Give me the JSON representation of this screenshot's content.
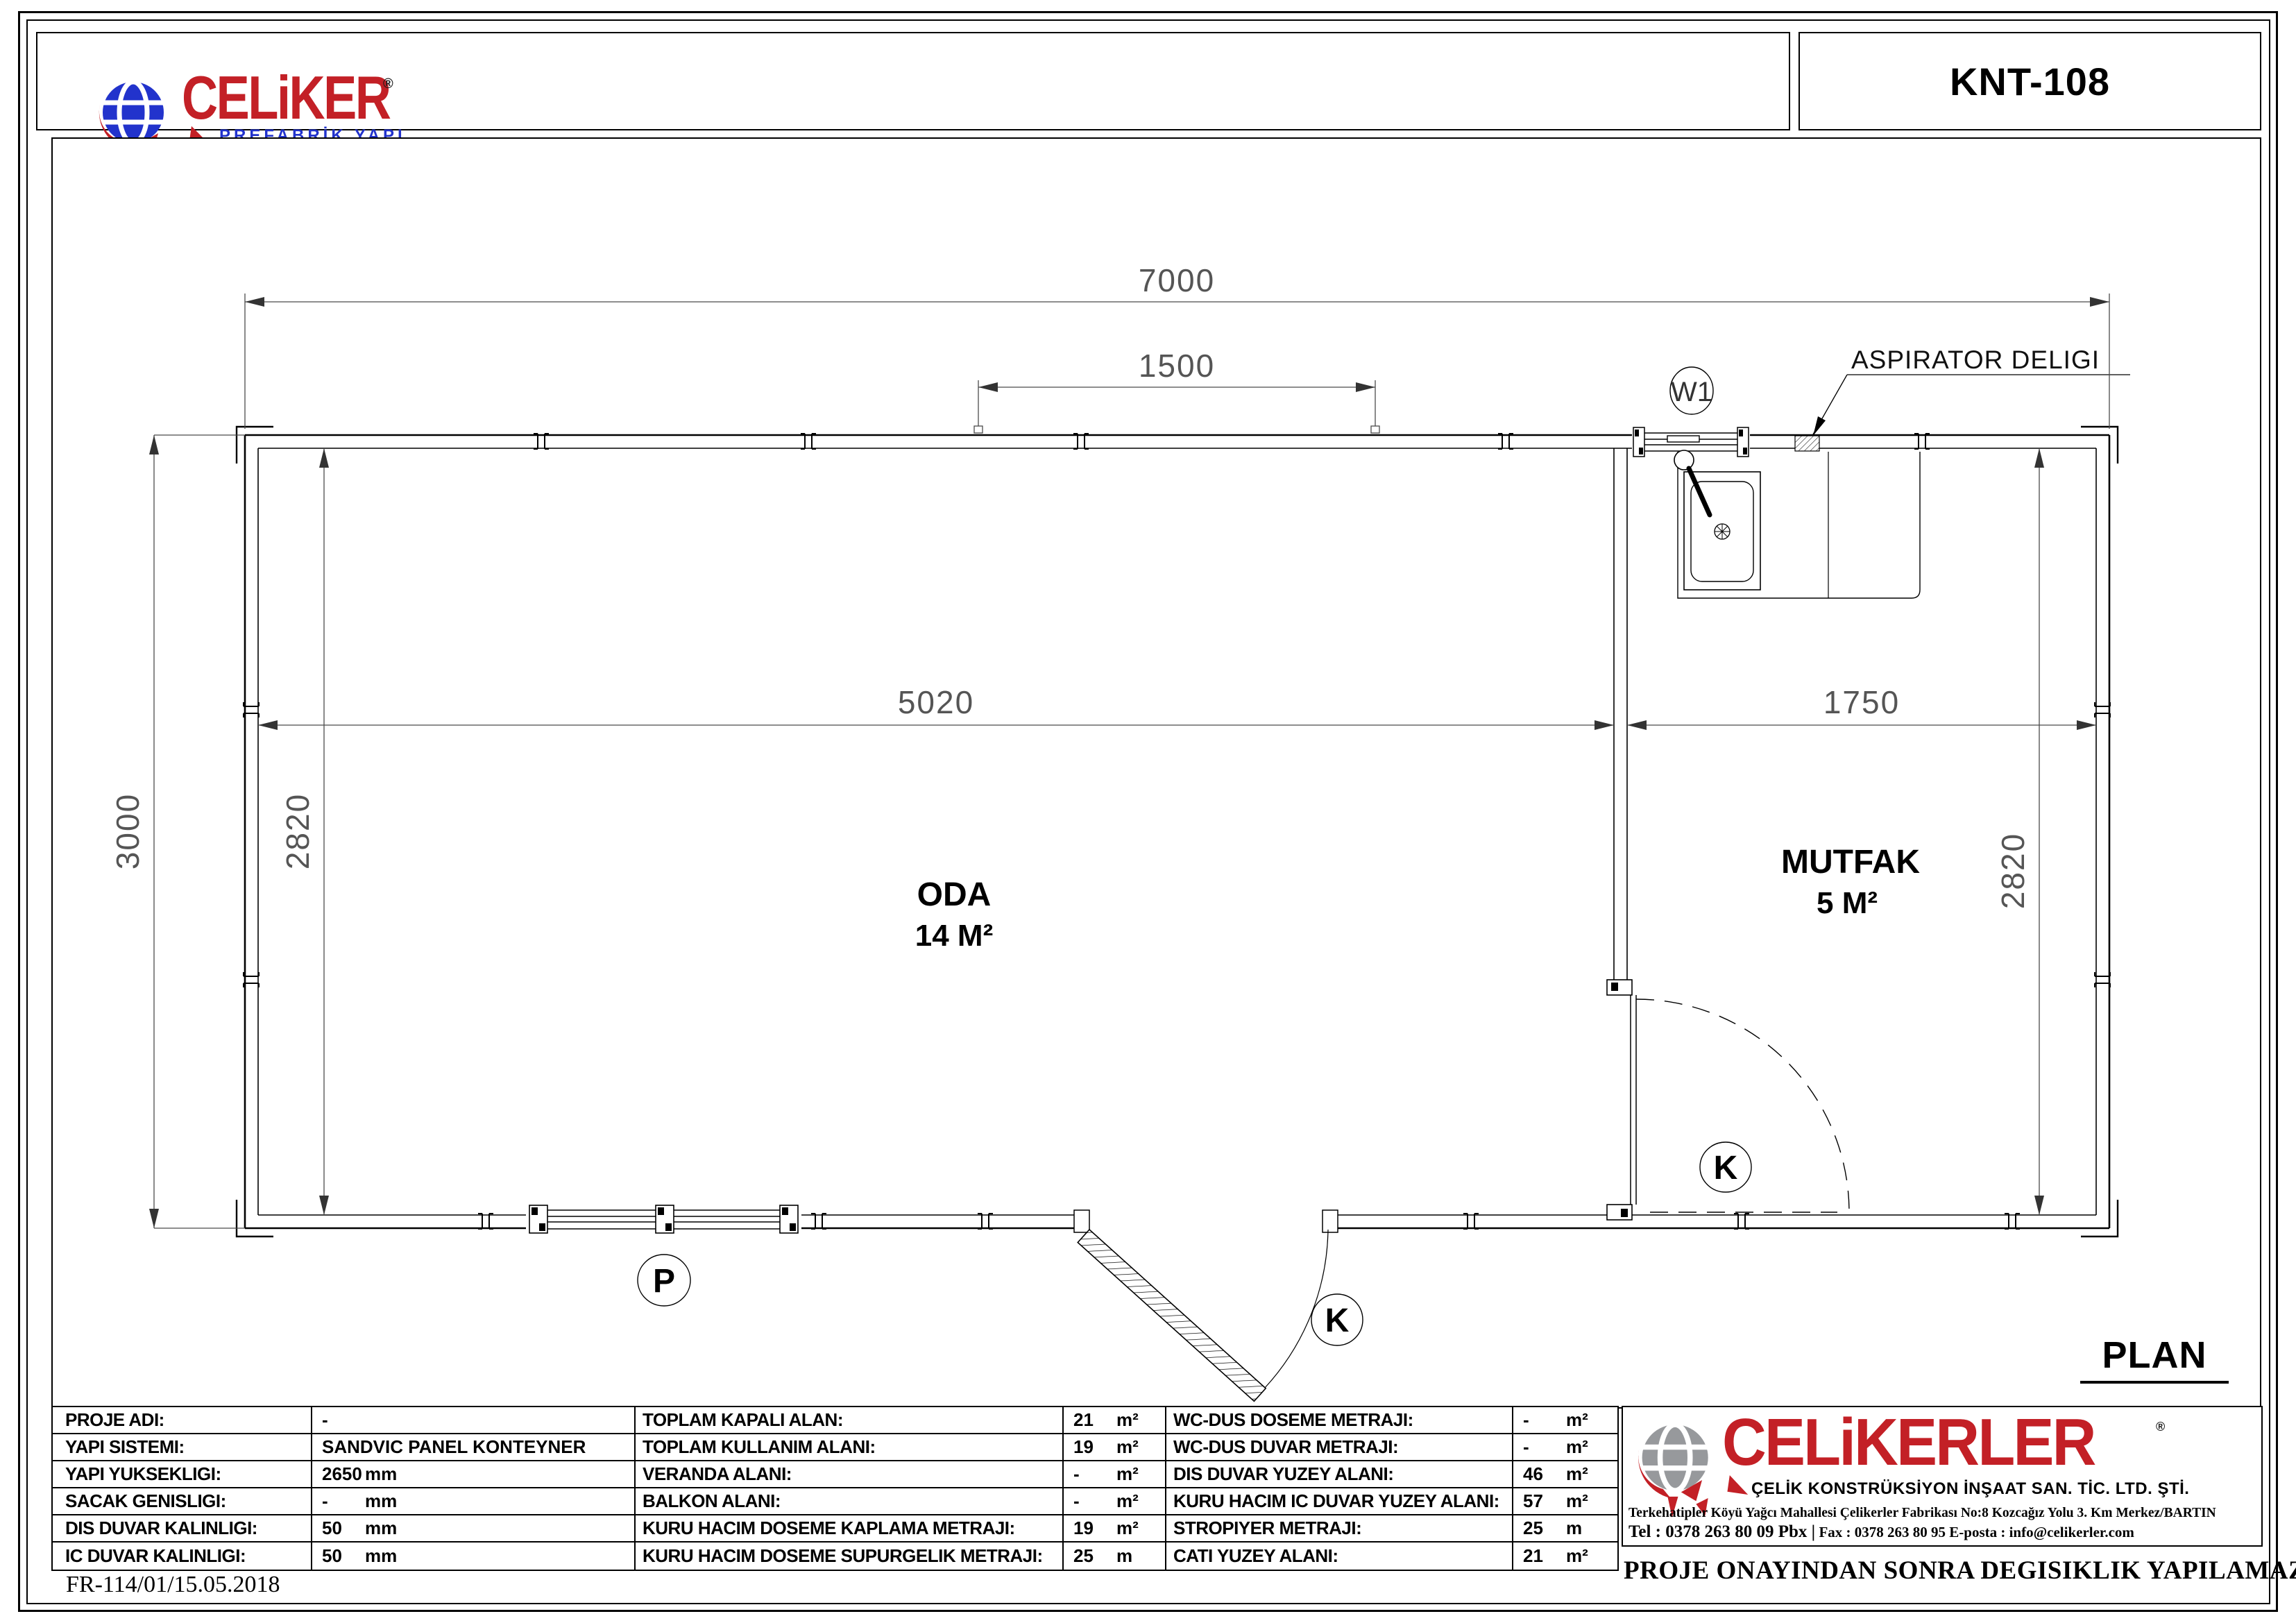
{
  "header": {
    "brand": {
      "name": "CELiKER",
      "registered": "®",
      "tagline": "PREFABRİK YAPI"
    },
    "model": "KNT-108"
  },
  "plan": {
    "title": "PLAN",
    "annotation": "ASPIRATOR DELIGI",
    "dims": {
      "total_width": "7000",
      "top_opening": "1500",
      "oda_width": "5020",
      "mutfak_width": "1750",
      "total_depth": "3000",
      "oda_depth": "2820",
      "mutfak_depth": "2820"
    },
    "rooms": {
      "oda": {
        "name": "ODA",
        "area": "14 M²"
      },
      "mutfak": {
        "name": "MUTFAK",
        "area": "5 M²"
      }
    },
    "marks": {
      "w1": "W1",
      "p": "P",
      "k_ext": "K",
      "k_int": "K"
    }
  },
  "tables": {
    "left": {
      "rows": [
        {
          "label": "PROJE ADI:",
          "value": "-",
          "unit": ""
        },
        {
          "label": "YAPI SISTEMI:",
          "value": "SANDVIC PANEL KONTEYNER",
          "unit": ""
        },
        {
          "label": "YAPI YUKSEKLIGI:",
          "value": "2650",
          "unit": "mm"
        },
        {
          "label": "SACAK GENISLIGI:",
          "value": "-",
          "unit": "mm"
        },
        {
          "label": "DIS DUVAR KALINLIGI:",
          "value": "50",
          "unit": "mm"
        },
        {
          "label": "IC DUVAR KALINLIGI:",
          "value": "50",
          "unit": "mm"
        }
      ]
    },
    "middle": {
      "rows": [
        {
          "label": "TOPLAM KAPALI ALAN:",
          "value": "21",
          "unit": "m²"
        },
        {
          "label": "TOPLAM KULLANIM ALANI:",
          "value": "19",
          "unit": "m²"
        },
        {
          "label": "VERANDA ALANI:",
          "value": "-",
          "unit": "m²"
        },
        {
          "label": "BALKON ALANI:",
          "value": "-",
          "unit": "m²"
        },
        {
          "label": "KURU HACIM DOSEME KAPLAMA METRAJI:",
          "value": "19",
          "unit": "m²"
        },
        {
          "label": "KURU HACIM DOSEME SUPURGELIK METRAJI:",
          "value": "25",
          "unit": "m"
        }
      ]
    },
    "right": {
      "rows": [
        {
          "label": "WC-DUS DOSEME METRAJI:",
          "value": "-",
          "unit": "m²"
        },
        {
          "label": "WC-DUS DUVAR METRAJI:",
          "value": "-",
          "unit": "m²"
        },
        {
          "label": "DIS DUVAR YUZEY ALANI:",
          "value": "46",
          "unit": "m²"
        },
        {
          "label": "KURU HACIM IC DUVAR YUZEY ALANI:",
          "value": "57",
          "unit": "m²"
        },
        {
          "label": "STROPIYER METRAJI:",
          "value": "25",
          "unit": "m"
        },
        {
          "label": "CATI YUZEY ALANI:",
          "value": "21",
          "unit": "m²"
        }
      ]
    }
  },
  "company": {
    "name": "CELiKERLER",
    "registered": "®",
    "subtitle": "ÇELİK KONSTRÜKSİYON İNŞAAT SAN. TİC. LTD. ŞTİ.",
    "address": "Terkehatipler Köyü Yağcı Mahallesi Çelikerler Fabrikası No:8 Kozcağız Yolu 3. Km Merkez/BARTIN",
    "tel": "Tel : 0378 263 80 09 Pbx |",
    "fax_email": "  Fax : 0378 263 80 95  E-posta : info@celikerler.com"
  },
  "footer": {
    "doc_code": "FR-114/01/15.05.2018",
    "note": "PROJE ONAYINDAN SONRA DEGISIKLIK YAPILAMAZ."
  },
  "colors": {
    "brand_red": "#c32026",
    "brand_blue": "#2233cc",
    "globe_gray": "#97999c"
  }
}
